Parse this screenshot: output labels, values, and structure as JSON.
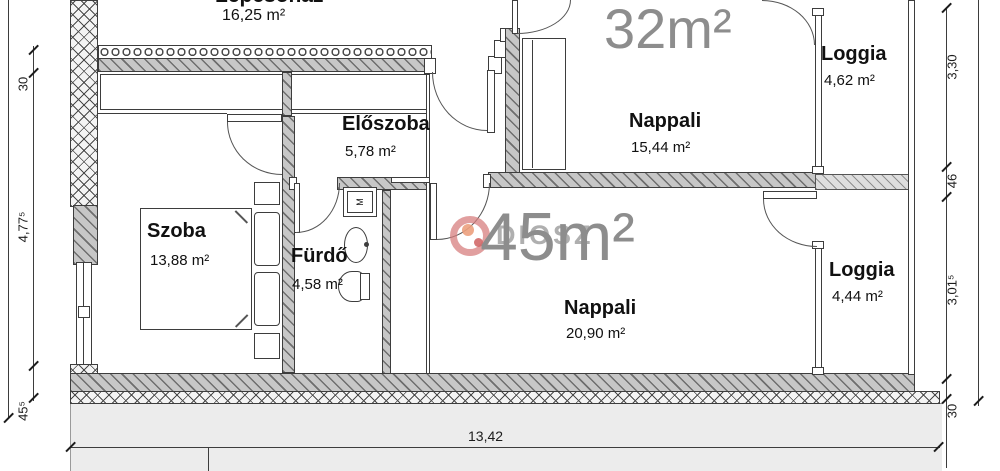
{
  "rooms": {
    "lepcsohaz": {
      "name": "Lépcsőház",
      "area": "16,25 m²"
    },
    "eloszoba": {
      "name": "Előszoba",
      "area": "5,78 m²"
    },
    "szoba": {
      "name": "Szoba",
      "area": "13,88 m²"
    },
    "furdo": {
      "name": "Fürdő",
      "area": "4,58 m²"
    },
    "nappali_upper": {
      "name": "Nappali",
      "area": "15,44 m²"
    },
    "loggia_upper": {
      "name": "Loggia",
      "area": "4,62 m²"
    },
    "nappali_lower": {
      "name": "Nappali",
      "area": "20,90 m²"
    },
    "loggia_lower": {
      "name": "Loggia",
      "area": "4,44 m²"
    }
  },
  "sizes": {
    "upper": "32m²",
    "lower": "45m²"
  },
  "dims": {
    "left_wall_top": "30",
    "left_height": "4,77⁵",
    "left_wall_bottom": "45⁵",
    "right_top": "3,30",
    "right_slab": "46",
    "right_lower": "3,01⁵",
    "right_wall_bottom": "30",
    "bottom_width": "13,42"
  },
  "fixtures": {
    "washing_machine": "M"
  },
  "watermark": {
    "text": "DIOSZ"
  },
  "colors": {
    "line": "#3d3d3d",
    "wall_fill": "#c7c7c7",
    "big_label": "#8d8d8d",
    "watermark_pink": "#d67a7a",
    "ground": "#ececec"
  }
}
